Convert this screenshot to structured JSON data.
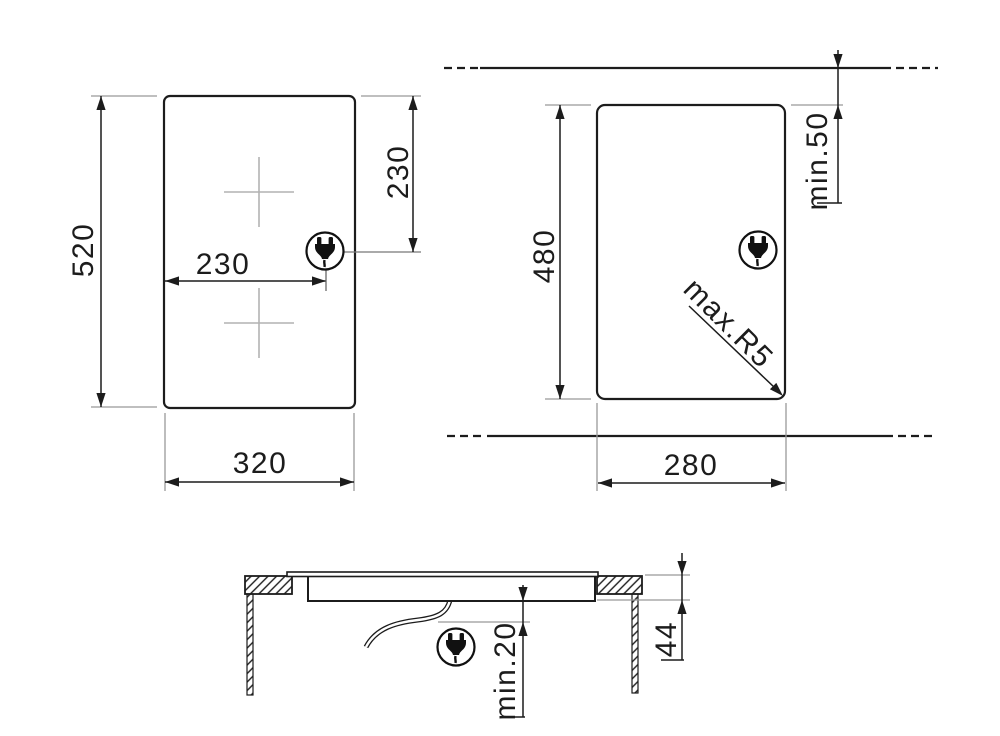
{
  "drawing": {
    "views": {
      "top_view": {
        "name": "hob-top-view",
        "height": "520",
        "width": "320",
        "plug_offset_horizontal": "230",
        "plug_offset_vertical": "230"
      },
      "cutout_view": {
        "name": "worktop-cutout-view",
        "height": "480",
        "width": "280",
        "edge_clearance": "min.50",
        "corner_radius": "max.R5"
      },
      "section_view": {
        "name": "installation-section-view",
        "bottom_clearance": "min.20",
        "total_depth": "44"
      }
    },
    "icons": {
      "plug": "power-plug-icon"
    },
    "colors": {
      "line": "#1c1c1c",
      "extension_line": "#999999",
      "crosshair": "#b2b2b2",
      "background": "#ffffff"
    }
  }
}
